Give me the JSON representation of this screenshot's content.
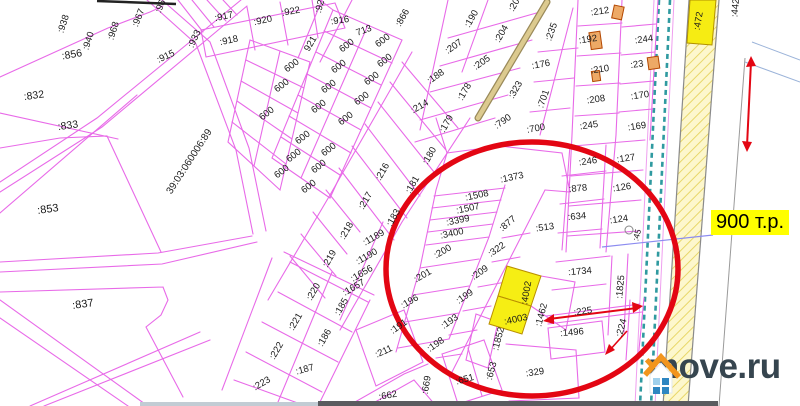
{
  "map": {
    "region_code": "39:03:060006:89",
    "line_color": "#e86ae8",
    "labels": [
      {
        "t": ":856",
        "x": 72,
        "y": 55,
        "r": -10,
        "s": 10.5
      },
      {
        "t": ":938",
        "x": 64,
        "y": 24,
        "r": -72
      },
      {
        "t": ":940",
        "x": 89,
        "y": 41,
        "r": -72
      },
      {
        "t": ":968",
        "x": 114,
        "y": 31,
        "r": -72
      },
      {
        "t": ":967",
        "x": 139,
        "y": 18,
        "r": -68
      },
      {
        "t": ":966",
        "x": 162,
        "y": 4,
        "r": -68
      },
      {
        "t": ":933",
        "x": 195,
        "y": 39,
        "r": -65
      },
      {
        "t": ":915",
        "x": 166,
        "y": 57,
        "r": -25
      },
      {
        "t": ":832",
        "x": 34,
        "y": 96,
        "r": -8,
        "s": 10.5
      },
      {
        "t": ":833",
        "x": 68,
        "y": 126,
        "r": -8,
        "s": 10.5
      },
      {
        "t": ":853",
        "x": 48,
        "y": 210,
        "r": -8,
        "s": 11
      },
      {
        "t": ":837",
        "x": 83,
        "y": 305,
        "r": -8,
        "s": 11
      },
      {
        "t": "39:03:060006:89",
        "x": 190,
        "y": 162,
        "r": -57,
        "s": 10
      },
      {
        "t": ":917",
        "x": 224,
        "y": 17,
        "r": -12
      },
      {
        "t": ":918",
        "x": 229,
        "y": 41,
        "r": -12
      },
      {
        "t": ":920",
        "x": 263,
        "y": 21,
        "r": -12
      },
      {
        "t": ":922",
        "x": 291,
        "y": 12,
        "r": -10
      },
      {
        "t": ":924",
        "x": 321,
        "y": 4,
        "r": -75
      },
      {
        "t": ":916",
        "x": 340,
        "y": 21,
        "r": -8
      },
      {
        "t": "713",
        "x": 364,
        "y": 31,
        "r": -20
      },
      {
        "t": "921",
        "x": 311,
        "y": 44,
        "r": -60
      },
      {
        "t": "600",
        "x": 347,
        "y": 46,
        "r": -38
      },
      {
        "t": "600",
        "x": 383,
        "y": 41,
        "r": -38
      },
      {
        "t": "600",
        "x": 385,
        "y": 61,
        "r": -38
      },
      {
        "t": "600",
        "x": 372,
        "y": 79,
        "r": -38
      },
      {
        "t": "600",
        "x": 362,
        "y": 99,
        "r": -38
      },
      {
        "t": "600",
        "x": 346,
        "y": 119,
        "r": -38
      },
      {
        "t": "600",
        "x": 339,
        "y": 67,
        "r": -38
      },
      {
        "t": "600",
        "x": 329,
        "y": 87,
        "r": -38
      },
      {
        "t": "600",
        "x": 319,
        "y": 107,
        "r": -38
      },
      {
        "t": "600",
        "x": 292,
        "y": 66,
        "r": -38
      },
      {
        "t": "600",
        "x": 282,
        "y": 86,
        "r": -38
      },
      {
        "t": "600",
        "x": 267,
        "y": 114,
        "r": -38
      },
      {
        "t": "600",
        "x": 303,
        "y": 138,
        "r": -38
      },
      {
        "t": "600",
        "x": 329,
        "y": 150,
        "r": -38
      },
      {
        "t": "600",
        "x": 294,
        "y": 156,
        "r": -38
      },
      {
        "t": "600",
        "x": 319,
        "y": 167,
        "r": -38
      },
      {
        "t": "600",
        "x": 282,
        "y": 172,
        "r": -38
      },
      {
        "t": "600",
        "x": 309,
        "y": 187,
        "r": -38
      },
      {
        "t": ":866",
        "x": 403,
        "y": 18,
        "r": -60
      },
      {
        "t": ":190",
        "x": 472,
        "y": 19,
        "r": -60
      },
      {
        "t": ":203",
        "x": 516,
        "y": 3,
        "r": -60
      },
      {
        "t": ":204",
        "x": 502,
        "y": 34,
        "r": -60
      },
      {
        "t": ":207",
        "x": 454,
        "y": 47,
        "r": -35
      },
      {
        "t": ":205",
        "x": 482,
        "y": 63,
        "r": -35
      },
      {
        "t": ":235",
        "x": 552,
        "y": 32,
        "r": -70
      },
      {
        "t": ":176",
        "x": 541,
        "y": 65,
        "r": -10
      },
      {
        "t": ":188",
        "x": 436,
        "y": 77,
        "r": -35
      },
      {
        "t": ":178",
        "x": 465,
        "y": 92,
        "r": -60
      },
      {
        "t": ":323",
        "x": 516,
        "y": 90,
        "r": -60
      },
      {
        "t": ":701",
        "x": 544,
        "y": 99,
        "r": -70
      },
      {
        "t": ":214",
        "x": 420,
        "y": 107,
        "r": -30
      },
      {
        "t": ":179",
        "x": 447,
        "y": 124,
        "r": -60
      },
      {
        "t": ":790",
        "x": 503,
        "y": 122,
        "r": -35
      },
      {
        "t": ":700",
        "x": 536,
        "y": 129,
        "r": -10
      },
      {
        "t": ":212",
        "x": 600,
        "y": 12,
        "r": -8
      },
      {
        "t": ":192",
        "x": 588,
        "y": 40,
        "r": -8
      },
      {
        "t": ":244",
        "x": 644,
        "y": 40,
        "r": -8
      },
      {
        "t": ":210",
        "x": 600,
        "y": 70,
        "r": -8
      },
      {
        "t": ":23",
        "x": 637,
        "y": 65,
        "r": -8
      },
      {
        "t": ":170",
        "x": 640,
        "y": 96,
        "r": -8
      },
      {
        "t": ":208",
        "x": 596,
        "y": 100,
        "r": -8
      },
      {
        "t": ":169",
        "x": 637,
        "y": 127,
        "r": -8
      },
      {
        "t": ":245",
        "x": 589,
        "y": 126,
        "r": -8
      },
      {
        "t": ":246",
        "x": 588,
        "y": 162,
        "r": -8
      },
      {
        "t": ":127",
        "x": 626,
        "y": 159,
        "r": -8
      },
      {
        "t": ":126",
        "x": 622,
        "y": 188,
        "r": -8
      },
      {
        "t": ":124",
        "x": 619,
        "y": 220,
        "r": -8
      },
      {
        "t": ":45",
        "x": 637,
        "y": 235,
        "r": -75,
        "s": 8.5
      },
      {
        "t": ":472",
        "x": 699,
        "y": 21,
        "r": -80
      },
      {
        "t": ":442",
        "x": 736,
        "y": 8,
        "r": -85
      },
      {
        "t": ":216",
        "x": 383,
        "y": 172,
        "r": -60
      },
      {
        "t": ":217",
        "x": 366,
        "y": 201,
        "r": -60
      },
      {
        "t": ":218",
        "x": 347,
        "y": 231,
        "r": -60
      },
      {
        "t": ":219",
        "x": 330,
        "y": 259,
        "r": -60
      },
      {
        "t": ":180",
        "x": 430,
        "y": 156,
        "r": -60
      },
      {
        "t": ":181",
        "x": 413,
        "y": 185,
        "r": -60
      },
      {
        "t": ":183",
        "x": 394,
        "y": 218,
        "r": -60
      },
      {
        "t": ":1189",
        "x": 374,
        "y": 238,
        "r": -30
      },
      {
        "t": ":1190",
        "x": 367,
        "y": 257,
        "r": -30
      },
      {
        "t": ":1656",
        "x": 362,
        "y": 274,
        "r": -30
      },
      {
        "t": ":1657",
        "x": 354,
        "y": 288,
        "r": -30
      },
      {
        "t": ":185",
        "x": 342,
        "y": 307,
        "r": -60
      },
      {
        "t": ":186",
        "x": 325,
        "y": 338,
        "r": -60
      },
      {
        "t": ":187",
        "x": 305,
        "y": 370,
        "r": -15
      },
      {
        "t": ":220",
        "x": 314,
        "y": 292,
        "r": -60
      },
      {
        "t": ":221",
        "x": 296,
        "y": 322,
        "r": -60
      },
      {
        "t": ":222",
        "x": 277,
        "y": 351,
        "r": -60
      },
      {
        "t": ":223",
        "x": 262,
        "y": 384,
        "r": -30
      },
      {
        "t": ":1373",
        "x": 512,
        "y": 178,
        "r": -12
      },
      {
        "t": ":1508",
        "x": 477,
        "y": 196,
        "r": -12
      },
      {
        "t": ":1507",
        "x": 468,
        "y": 209,
        "r": -12
      },
      {
        "t": ":3399",
        "x": 458,
        "y": 221,
        "r": -12
      },
      {
        "t": ":3400",
        "x": 452,
        "y": 234,
        "r": -12
      },
      {
        "t": ":200",
        "x": 443,
        "y": 252,
        "r": -30
      },
      {
        "t": ":201",
        "x": 423,
        "y": 276,
        "r": -30
      },
      {
        "t": ":196",
        "x": 410,
        "y": 302,
        "r": -30
      },
      {
        "t": ":191",
        "x": 399,
        "y": 327,
        "r": -35
      },
      {
        "t": ":877",
        "x": 508,
        "y": 224,
        "r": -40
      },
      {
        "t": ":322",
        "x": 497,
        "y": 250,
        "r": -35
      },
      {
        "t": ":209",
        "x": 480,
        "y": 273,
        "r": -35
      },
      {
        "t": ":199",
        "x": 465,
        "y": 297,
        "r": -35
      },
      {
        "t": ":193",
        "x": 450,
        "y": 322,
        "r": -35
      },
      {
        "t": ":198",
        "x": 436,
        "y": 345,
        "r": -35
      },
      {
        "t": ":513",
        "x": 545,
        "y": 228,
        "r": -8
      },
      {
        "t": ":878",
        "x": 578,
        "y": 189,
        "r": -5
      },
      {
        "t": ":634",
        "x": 577,
        "y": 217,
        "r": -5
      },
      {
        "t": ":1734",
        "x": 580,
        "y": 272,
        "r": -5
      },
      {
        "t": ":1825",
        "x": 621,
        "y": 287,
        "r": -85
      },
      {
        "t": ":4002",
        "x": 527,
        "y": 293,
        "r": -80
      },
      {
        "t": ":4003",
        "x": 516,
        "y": 320,
        "r": -12
      },
      {
        "t": ":1852",
        "x": 499,
        "y": 339,
        "r": -75
      },
      {
        "t": ":1462",
        "x": 542,
        "y": 315,
        "r": -75
      },
      {
        "t": ":225",
        "x": 583,
        "y": 312,
        "r": -8
      },
      {
        "t": ":1496",
        "x": 572,
        "y": 333,
        "r": -5
      },
      {
        "t": ":224",
        "x": 622,
        "y": 328,
        "r": -75
      },
      {
        "t": ":211",
        "x": 384,
        "y": 352,
        "r": -25
      },
      {
        "t": ":662",
        "x": 388,
        "y": 396,
        "r": -10
      },
      {
        "t": ":669",
        "x": 427,
        "y": 385,
        "r": -80
      },
      {
        "t": ":651",
        "x": 465,
        "y": 380,
        "r": -15
      },
      {
        "t": ":653",
        "x": 492,
        "y": 371,
        "r": -75
      },
      {
        "t": ":329",
        "x": 535,
        "y": 373,
        "r": -8
      }
    ]
  },
  "price": {
    "text": "900 т.р.",
    "bg": "#ffff00",
    "text_color": "#000000"
  },
  "watermark": {
    "text": "move.ru",
    "text_color": "#36454f",
    "roof_color": "#f2951d",
    "window_blue": "#2e86c1",
    "window_light": "#9fd0ec"
  },
  "highlight": {
    "circle_color": "#e30613",
    "selected_parcels": [
      ":4002",
      ":4003"
    ],
    "selected_fill": "#f6ee14"
  }
}
